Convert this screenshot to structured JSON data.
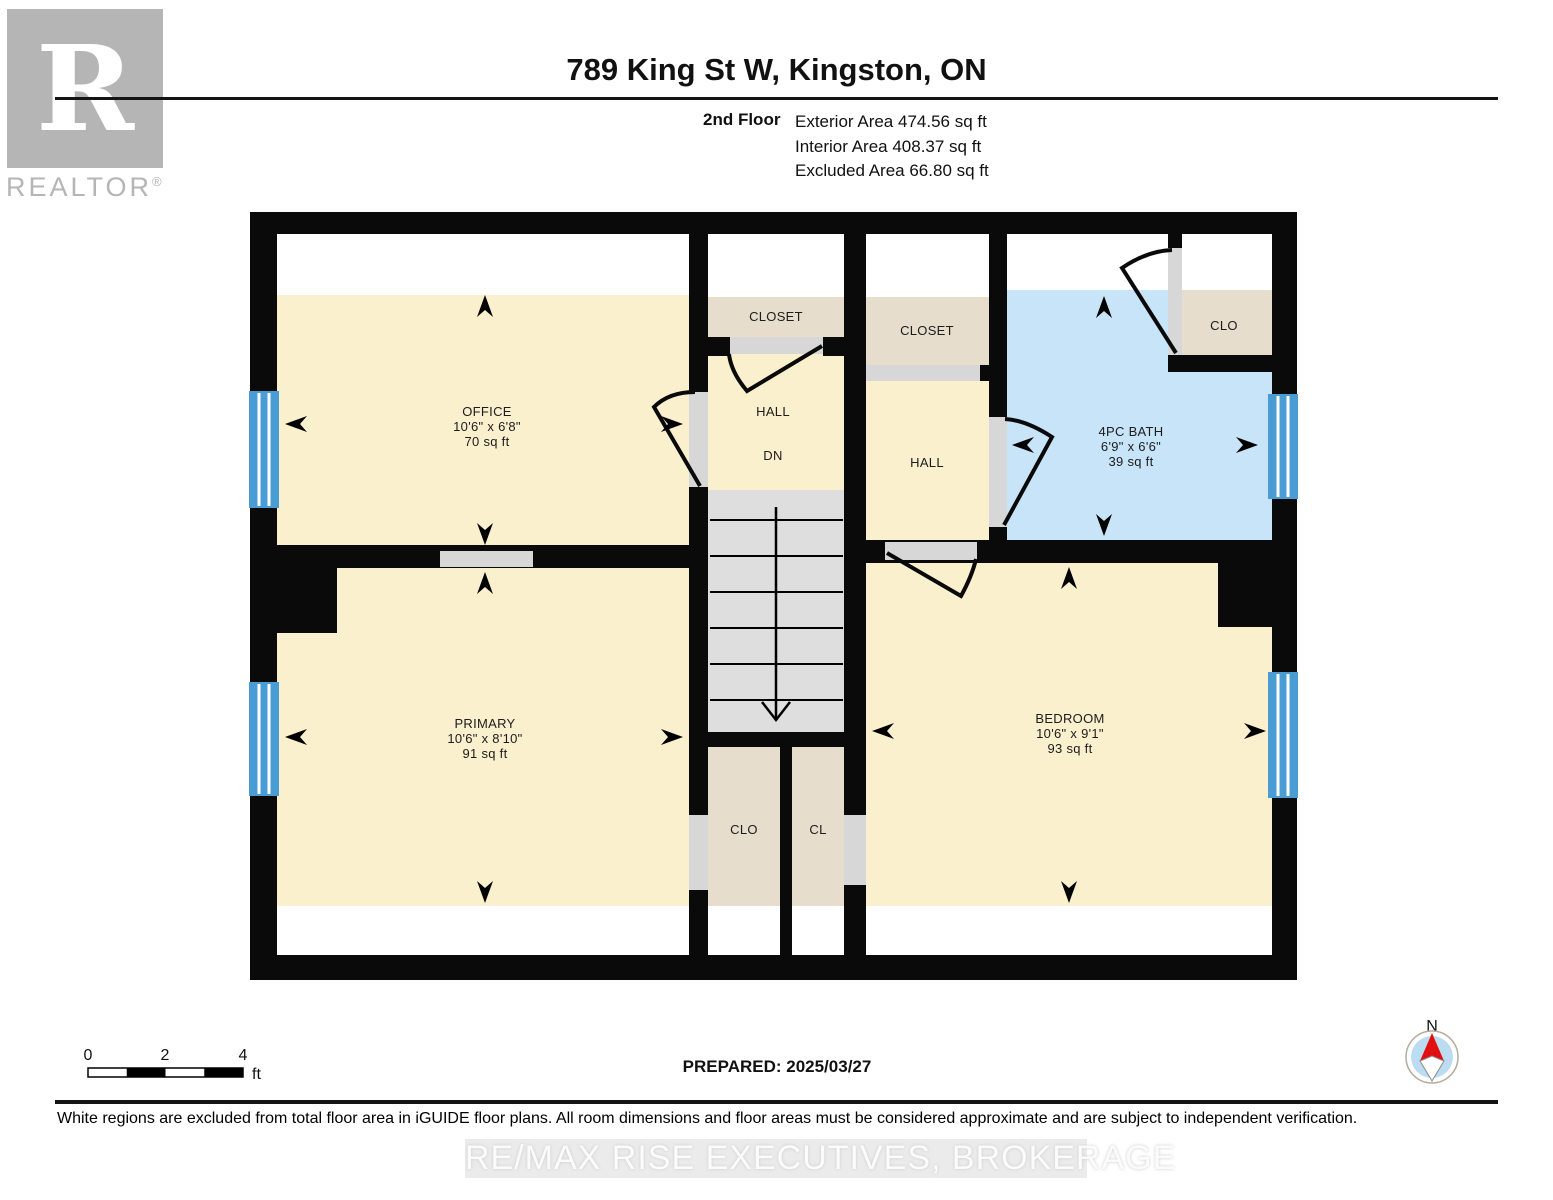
{
  "header": {
    "title": "789 King St W, Kingston, ON",
    "floor_label": "2nd Floor",
    "exterior": "Exterior Area 474.56 sq ft",
    "interior": "Interior Area 408.37 sq ft",
    "excluded": "Excluded Area 66.80 sq ft"
  },
  "branding": {
    "logo_letter": "R",
    "logo_wordmark": "REALTOR",
    "registered_mark": "®",
    "watermark": "RE/MAX RISE EXECUTIVES, BROKERAGE"
  },
  "plan": {
    "rooms": {
      "office": {
        "name": "OFFICE",
        "dims": "10'6\" x 6'8\"",
        "area": "70 sq ft"
      },
      "closet_left": {
        "name": "CLOSET"
      },
      "hall_left": {
        "name": "HALL",
        "note": "DN"
      },
      "closet_right": {
        "name": "CLOSET"
      },
      "hall_right": {
        "name": "HALL"
      },
      "bath": {
        "name": "4PC BATH",
        "dims": "6'9\" x 6'6\"",
        "area": "39 sq ft"
      },
      "clo_top": {
        "name": "CLO"
      },
      "primary": {
        "name": "PRIMARY",
        "dims": "10'6\" x 8'10\"",
        "area": "91 sq ft"
      },
      "bedroom": {
        "name": "BEDROOM",
        "dims": "10'6\" x 9'1\"",
        "area": "93 sq ft"
      },
      "clo_bottom": {
        "name": "CLO"
      },
      "cl": {
        "name": "CL"
      }
    },
    "colors": {
      "wall": "#0a0a0a",
      "room": "#faf0cd",
      "closet": "#e6ddcc",
      "bath": "#c8e4f8",
      "window": "#4a9cd5",
      "opening": "#d7d7d7",
      "stairs": "#dedede",
      "excluded": "#ffffff"
    }
  },
  "footer": {
    "scale_ticks": [
      "0",
      "2",
      "4"
    ],
    "scale_unit": "ft",
    "prepared": "PREPARED: 2025/03/27",
    "compass_north": "N",
    "disclaimer": "White regions are excluded from total floor area in iGUIDE floor plans. All room dimensions and floor areas must be considered approximate and are subject to independent verification."
  }
}
